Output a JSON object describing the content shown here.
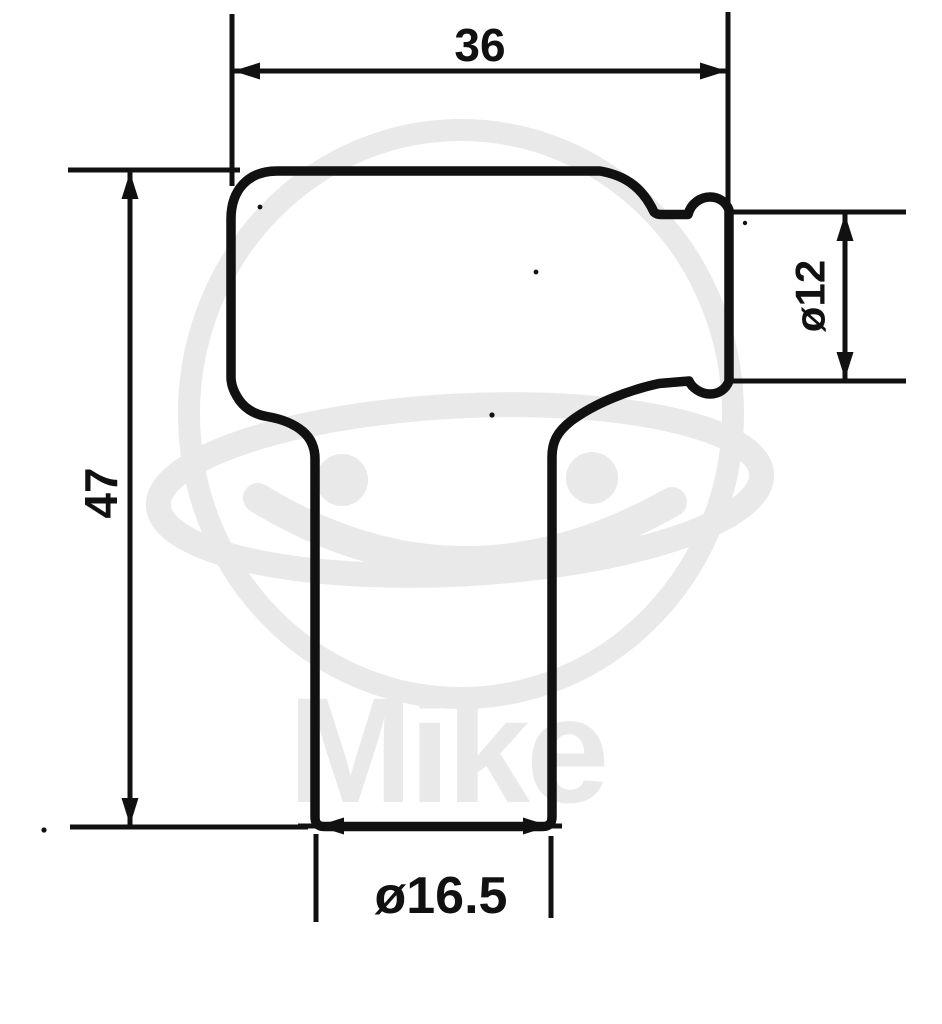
{
  "colors": {
    "line": "#111111",
    "watermark": "#e9e9e9",
    "background": "#ffffff"
  },
  "watermark": {
    "text": "Mike"
  },
  "dimensions": {
    "overall_width": "36",
    "overall_height": "47",
    "terminal_diameter": "ø12",
    "boot_diameter": "ø16.5"
  }
}
